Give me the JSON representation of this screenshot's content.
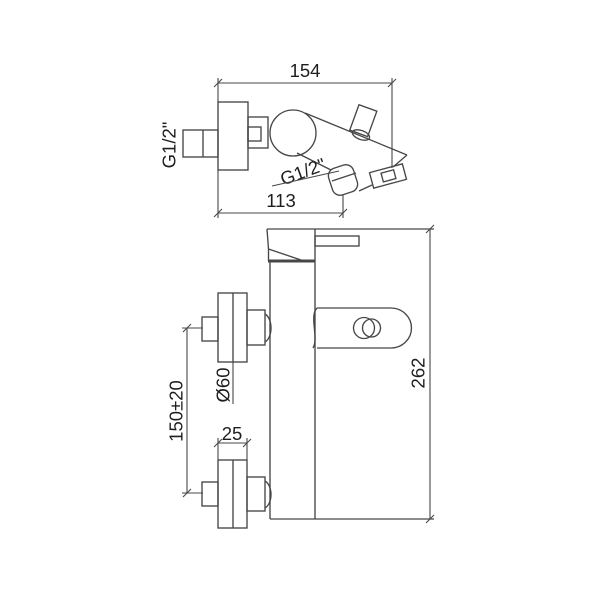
{
  "drawing": {
    "labels": {
      "top_width": "154",
      "wall_thread": "G1/2\"",
      "spout_thread": "G1/2\"",
      "spout_depth": "113",
      "body_height": "262",
      "escutcheon_diameter": "Ø60",
      "inlet_spacing": "150±20",
      "escutcheon_depth": "25"
    },
    "colors": {
      "line": "#474747",
      "text": "#1e1e1e",
      "background": "#ffffff"
    }
  }
}
